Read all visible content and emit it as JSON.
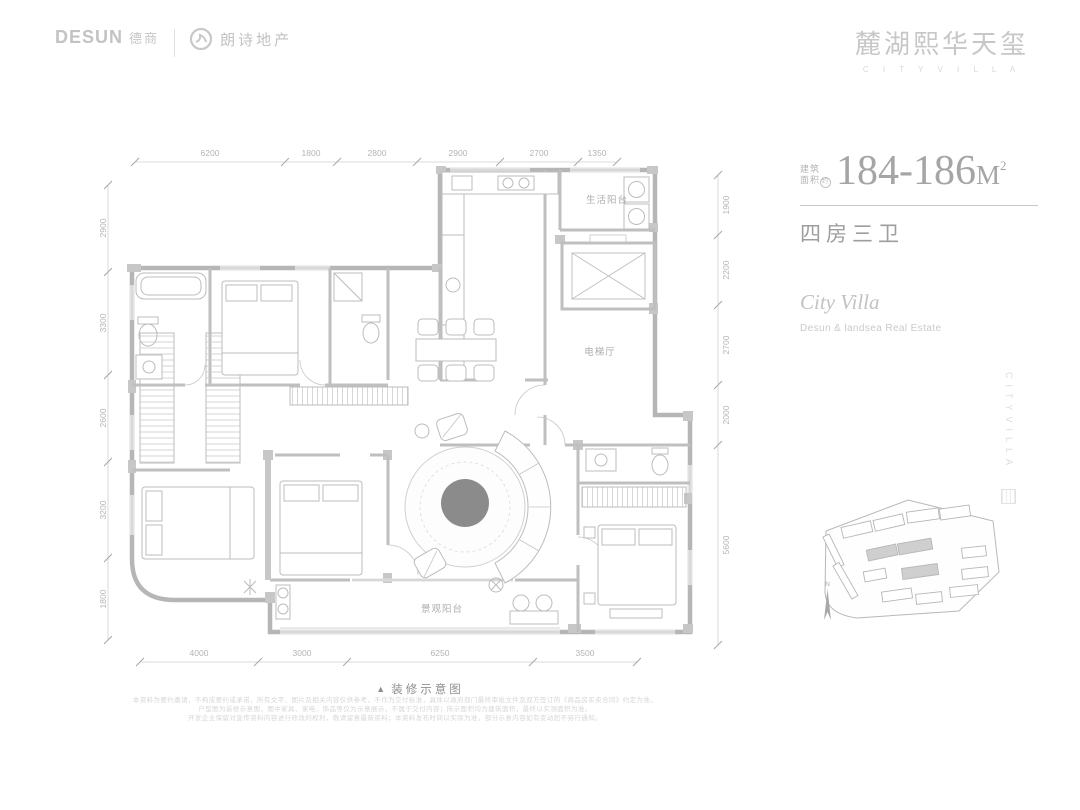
{
  "header": {
    "desun_en": "DESUN",
    "desun_cn": "德商",
    "desun_tagline": "· · · · · · · · · ·",
    "landsea_name": "朗诗地产",
    "brand_title": "麓湖熙华天玺",
    "brand_subtitle": "C I T Y V I L L A"
  },
  "info": {
    "area_label_line1": "建筑",
    "area_label_line2": "面积",
    "area_approx": "约",
    "area_value": "184-186",
    "area_unit": "M",
    "area_exp": "2",
    "layout_text": "四房三卫",
    "villa_en": "City Villa",
    "developer_en": "Desun & landsea Real Estate",
    "vertical_text": "CITYVILLA",
    "compass_label": "N"
  },
  "plan": {
    "labels": {
      "service_balcony": "生活阳台",
      "elevator_hall": "电梯厅",
      "view_balcony": "景观阳台"
    },
    "dims": {
      "top": [
        "6200",
        "1800",
        "2800",
        "2900",
        "2700",
        "1350"
      ],
      "bottom": [
        "4000",
        "3000",
        "6250",
        "3500"
      ],
      "left": [
        "2900",
        "3300",
        "2600",
        "3200",
        "1800"
      ],
      "right": [
        "1900",
        "2200",
        "2700",
        "2000",
        "5600"
      ]
    },
    "caption_marker": "▲",
    "caption": "装修示意图"
  },
  "footer": {
    "disclaimer_lines": [
      "本资料为要约邀请，不构成要约或承诺，所有文字、图片及相关内容仅供参考，不作为交付标准，具体以政府部门最终审批文件及双方签订的《商品房买卖合同》约定为准。",
      "户型图为装修示意图，图中家具、家电、饰品等仅为示意展示，不属于交付内容；所示面积均为建筑面积，最终以实测面积为准。",
      "开发企业保留对宣传资料内容进行修改的权利，敬请留意最新资料；本资料发布时间以实际为准，部分示意内容如有变动恕不另行通知。"
    ]
  },
  "colors": {
    "brand_gray": "#c7c7c7",
    "text_gray": "#a5a5a5",
    "wall_gray": "#b6b6b6",
    "table_dark": "#8b8b8b"
  }
}
